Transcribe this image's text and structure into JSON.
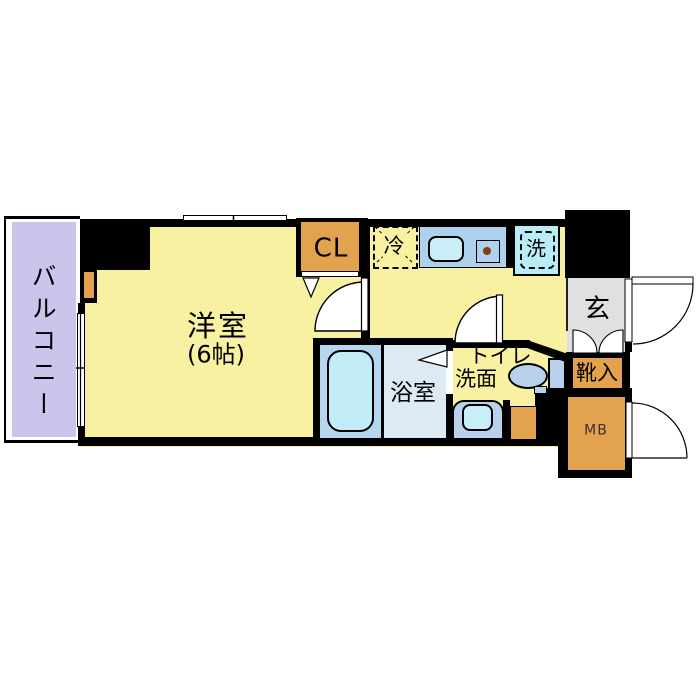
{
  "floorplan": {
    "title": "1K apartment floor plan",
    "labels": {
      "balcony": "バルコニー",
      "main_room": "洋室",
      "main_room_size": "(6帖)",
      "closet": "CL",
      "refrigerator": "冷",
      "washer": "洗",
      "bathroom": "浴室",
      "toilet_line1": "トイレ",
      "toilet_line2": "洗面",
      "entrance": "玄",
      "shoe_cabinet": "靴入",
      "meter_box": "MB"
    },
    "colors": {
      "floor_yellow": "#f7f1a1",
      "storage_orange": "#e2a24e",
      "balcony_lavender": "#ccc4eb",
      "entrance_gray": "#e0e0e0",
      "counter_blue": "#aed2ee",
      "sink_cyan": "#c8eef8",
      "washer_cyan": "#baecf8",
      "bath_tub_area": "#b6d6f0",
      "bath_wash_area": "#dde9f3",
      "fixture_blue": "#b8d0ec",
      "wall_black": "#000000"
    }
  }
}
